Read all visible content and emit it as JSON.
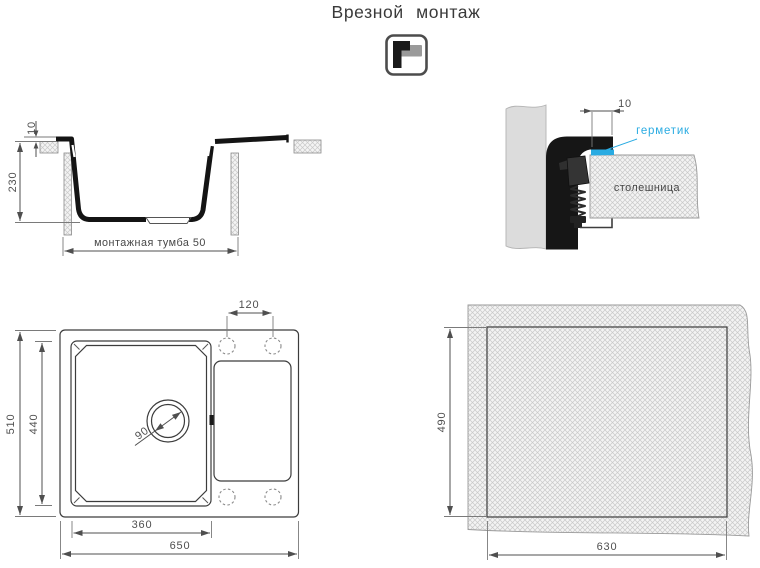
{
  "title": "Врезной монтаж",
  "icon": {
    "name": "inset-mount"
  },
  "colors": {
    "accent_cyan": "#29abe2",
    "drawing_black": "#141414",
    "dim_gray": "#4f4f4f"
  },
  "section_view": {
    "dim_rim_height": "10",
    "dim_depth": "230",
    "label_cabinet": "монтажная тумба 50"
  },
  "detail_view": {
    "dim_overhang": "10",
    "label_sealant": "герметик",
    "label_countertop": "столешница"
  },
  "top_view": {
    "dim_hole_spacing": "120",
    "dim_overall_depth": "510",
    "dim_bowl_depth": "440",
    "dim_drain_diameter": "90",
    "dim_bowl_width": "360",
    "dim_overall_width": "650"
  },
  "cutout_view": {
    "dim_cutout_depth": "490",
    "dim_cutout_width": "630"
  }
}
